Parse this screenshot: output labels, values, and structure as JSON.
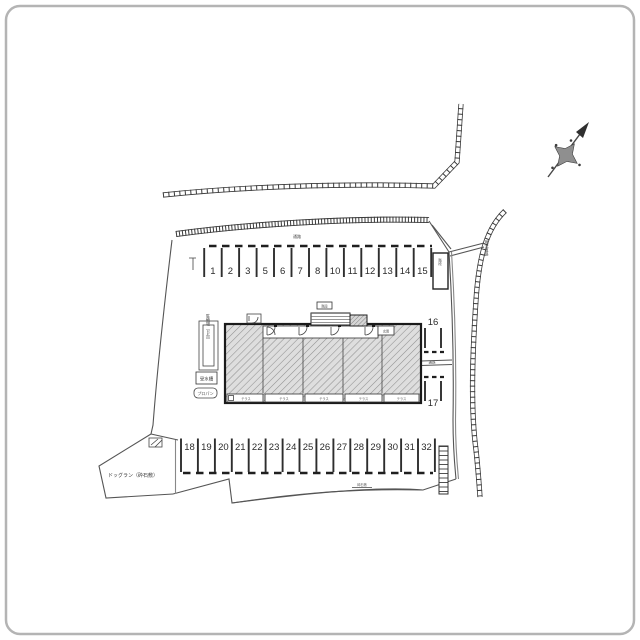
{
  "parking": {
    "top_row": [
      "1",
      "2",
      "3",
      "5",
      "6",
      "7",
      "8",
      "10",
      "11",
      "12",
      "13",
      "14",
      "15"
    ],
    "right_column": [
      "16",
      "17"
    ],
    "bottom_row": [
      "18",
      "19",
      "20",
      "21",
      "22",
      "23",
      "24",
      "25",
      "26",
      "27",
      "28",
      "29",
      "30",
      "31",
      "32"
    ]
  },
  "labels": {
    "bicycle_parking": "駐輪場（11台）",
    "water_tank": "受水槽",
    "propane": "プロパン",
    "dog_run": "ドッグラン（砕石敷）",
    "aisle_top": "通路",
    "aisle_mid": "通路",
    "stairs_side": "階段",
    "stairs_top": "階段",
    "entrance": "玄関",
    "road_right": "現況道路",
    "terrace": "テラス",
    "gravel_note": "砕石敷"
  },
  "colors": {
    "line": "#2a2a2a",
    "wall": "#3a3a3a",
    "hatch_fill": "#dedede",
    "hatch_line": "#909090",
    "frame": "#b4b4b4",
    "compass": "#8f8f8f"
  }
}
